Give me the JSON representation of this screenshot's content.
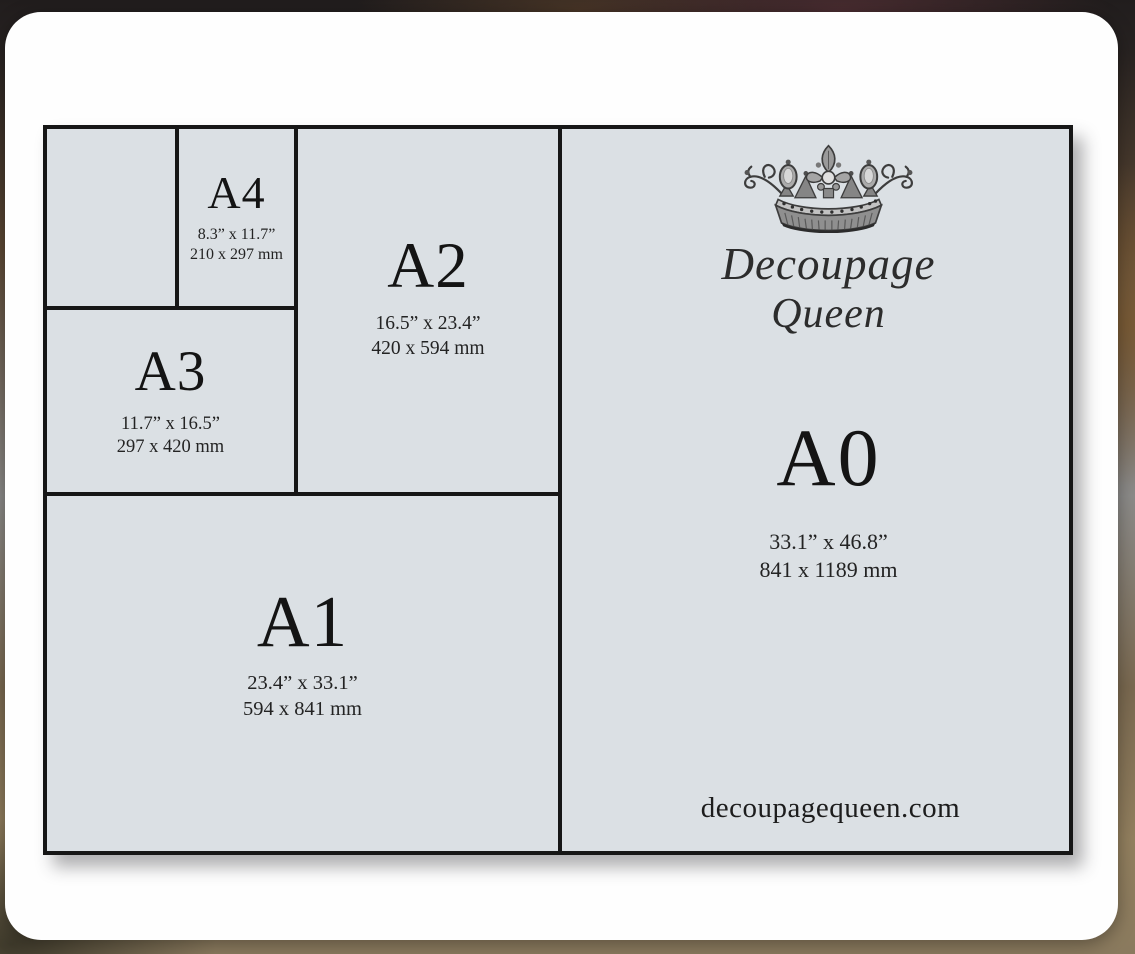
{
  "sizes": [
    {
      "code": "A0",
      "inches": "33.1” x 46.8”",
      "mm": "841 x 1189 mm"
    },
    {
      "code": "A1",
      "inches": "23.4” x 33.1”",
      "mm": "594 x 841 mm"
    },
    {
      "code": "A2",
      "inches": "16.5” x 23.4”",
      "mm": "420 x 594 mm"
    },
    {
      "code": "A3",
      "inches": "11.7” x 16.5”",
      "mm": "297 x 420 mm"
    },
    {
      "code": "A4",
      "inches": "8.3” x 11.7”",
      "mm": "210 x 297 mm"
    }
  ],
  "brand": {
    "name_line1": "Decoupage",
    "name_line2": "Queen",
    "website": "decoupagequeen.com",
    "logo": "crown-icon"
  },
  "colors": {
    "paper_fill": "#dbe0e4",
    "grid_line": "#161616",
    "card": "#fefefe",
    "text": "#141414"
  }
}
